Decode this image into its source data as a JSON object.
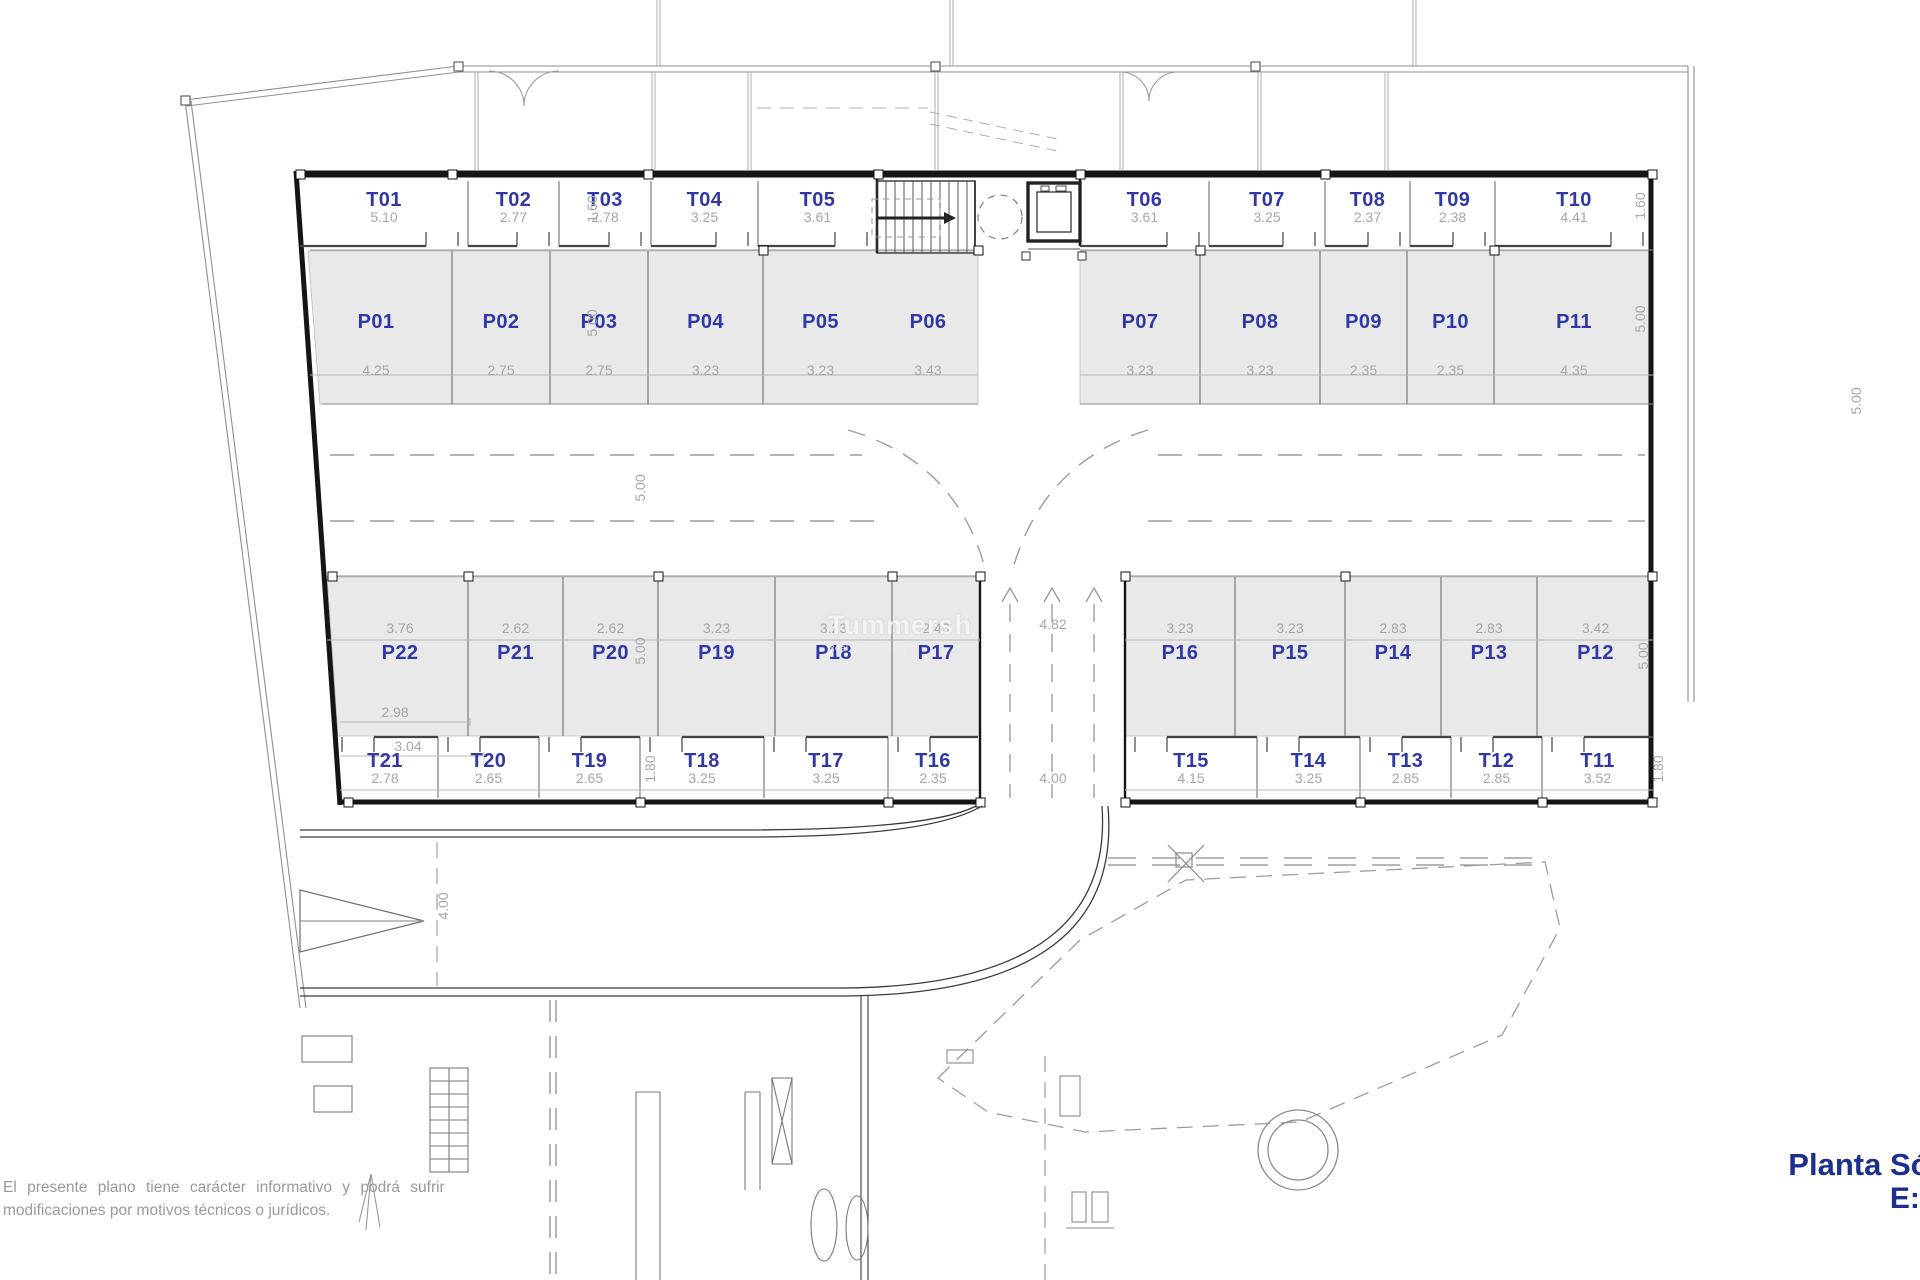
{
  "plan": {
    "title": {
      "line1": "Planta Sótano",
      "line2": "E:1/150"
    },
    "disclaimer": {
      "line1": "El presente plano tiene carácter informativo y podrá sufrir",
      "line2": "modificaciones por motivos técnicos o jurídicos."
    },
    "watermark": {
      "brand": "Tummersh",
      "subtitle": "Real Estate - Inm"
    },
    "storage_top": [
      {
        "id": "T01",
        "dim": "5.10"
      },
      {
        "id": "T02",
        "dim": "2.77"
      },
      {
        "id": "T03",
        "dim": "2.78"
      },
      {
        "id": "T04",
        "dim": "3.25"
      },
      {
        "id": "T05",
        "dim": "3.61"
      },
      {
        "id": "T06",
        "dim": "3.61"
      },
      {
        "id": "T07",
        "dim": "3.25"
      },
      {
        "id": "T08",
        "dim": "2.37"
      },
      {
        "id": "T09",
        "dim": "2.38"
      },
      {
        "id": "T10",
        "dim": "4.41"
      }
    ],
    "parking_top": [
      {
        "id": "P01",
        "dim": "4.25"
      },
      {
        "id": "P02",
        "dim": "2.75"
      },
      {
        "id": "P03",
        "dim": "2.75"
      },
      {
        "id": "P04",
        "dim": "3.23"
      },
      {
        "id": "P05",
        "dim": "3.23"
      },
      {
        "id": "P06",
        "dim": "3.43"
      },
      {
        "id": "P07",
        "dim": "3.23"
      },
      {
        "id": "P08",
        "dim": "3.23"
      },
      {
        "id": "P09",
        "dim": "2.35"
      },
      {
        "id": "P10",
        "dim": "2.35"
      },
      {
        "id": "P11",
        "dim": "4.35"
      }
    ],
    "parking_bottom": [
      {
        "id": "P22",
        "dim": "3.76"
      },
      {
        "id": "P21",
        "dim": "2.62"
      },
      {
        "id": "P20",
        "dim": "2.62"
      },
      {
        "id": "P19",
        "dim": "3.23"
      },
      {
        "id": "P18",
        "dim": "3.23"
      },
      {
        "id": "P17",
        "dim": "2.43"
      },
      {
        "id": "P16",
        "dim": "3.23"
      },
      {
        "id": "P15",
        "dim": "3.23"
      },
      {
        "id": "P14",
        "dim": "2.83"
      },
      {
        "id": "P13",
        "dim": "2.83"
      },
      {
        "id": "P12",
        "dim": "3.42"
      }
    ],
    "storage_bottom": [
      {
        "id": "T21",
        "dim": "2.78"
      },
      {
        "id": "T20",
        "dim": "2.65"
      },
      {
        "id": "T19",
        "dim": "2.65"
      },
      {
        "id": "T18",
        "dim": "3.25"
      },
      {
        "id": "T17",
        "dim": "3.25"
      },
      {
        "id": "T16",
        "dim": "2.35"
      },
      {
        "id": "T15",
        "dim": "4.15"
      },
      {
        "id": "T14",
        "dim": "3.25"
      },
      {
        "id": "T13",
        "dim": "2.85"
      },
      {
        "id": "T12",
        "dim": "2.85"
      },
      {
        "id": "T11",
        "dim": "3.52"
      }
    ],
    "side_dims": {
      "t03_depth": "1.60",
      "p03_depth": "5.00",
      "t10_depth": "1.60",
      "p11_depth": "5.00",
      "aisle_left": "5.00",
      "aisle_right": "5.00",
      "p20_depth": "5.00",
      "p12_depth": "5.00",
      "t19_depth": "1.80",
      "t11_depth": "1.80",
      "lane_center_width": "4.82",
      "lane_bottom_width": "4.00",
      "ramp_width": "4.00",
      "p22_dim_inner": "2.98",
      "p22_dim_outer": "3.04"
    },
    "colors": {
      "label_blue": "#3138a6",
      "title_navy": "#1c2e8e",
      "dim_gray": "#a6a6a6",
      "bay_fill": "#e9e9e9"
    }
  }
}
